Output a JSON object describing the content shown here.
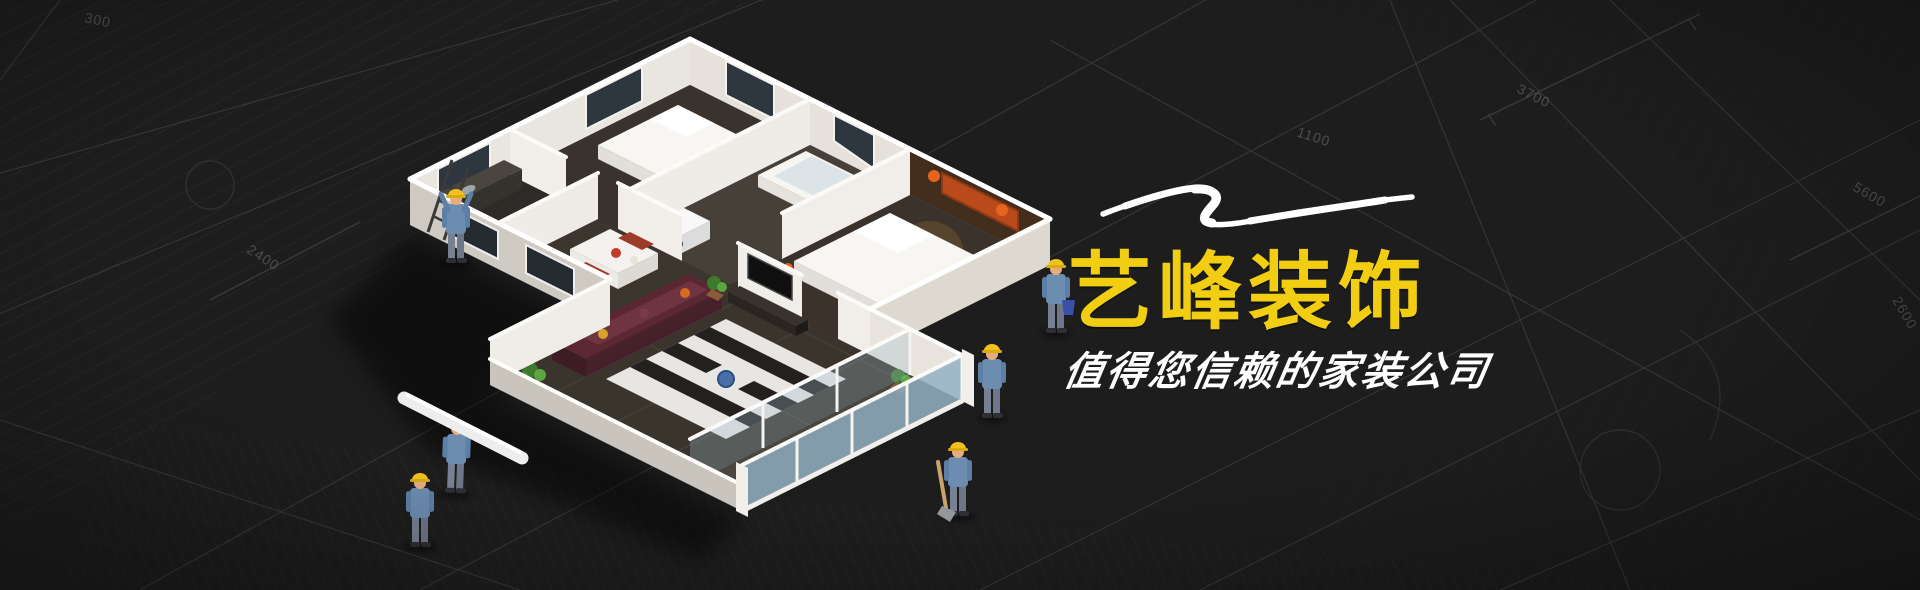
{
  "banner": {
    "title": "艺峰装饰",
    "subtitle": "值得您信赖的家装公司",
    "colors": {
      "background": "#1D1D1D",
      "title_yellow": "#F2CE12",
      "subtitle_white": "#FFFFFF",
      "swoosh_white": "#FFFFFF",
      "hardhat_yellow": "#F2C11D",
      "accent_orange": "#E8641E"
    }
  },
  "blueprint_background": {
    "dimension_labels": [
      "3700",
      "5600",
      "2600",
      "1100",
      "2400",
      "300"
    ]
  },
  "illustration": {
    "model": "isometric-apartment-cutaway-model",
    "figures": [
      {
        "name": "worker-on-ladder"
      },
      {
        "name": "worker-carrying-pipe"
      },
      {
        "name": "worker-walking-with-plan"
      },
      {
        "name": "worker-standing-back"
      },
      {
        "name": "worker-with-shovel"
      },
      {
        "name": "worker-with-bucket"
      }
    ],
    "flourish": "white-brush-swoosh"
  }
}
